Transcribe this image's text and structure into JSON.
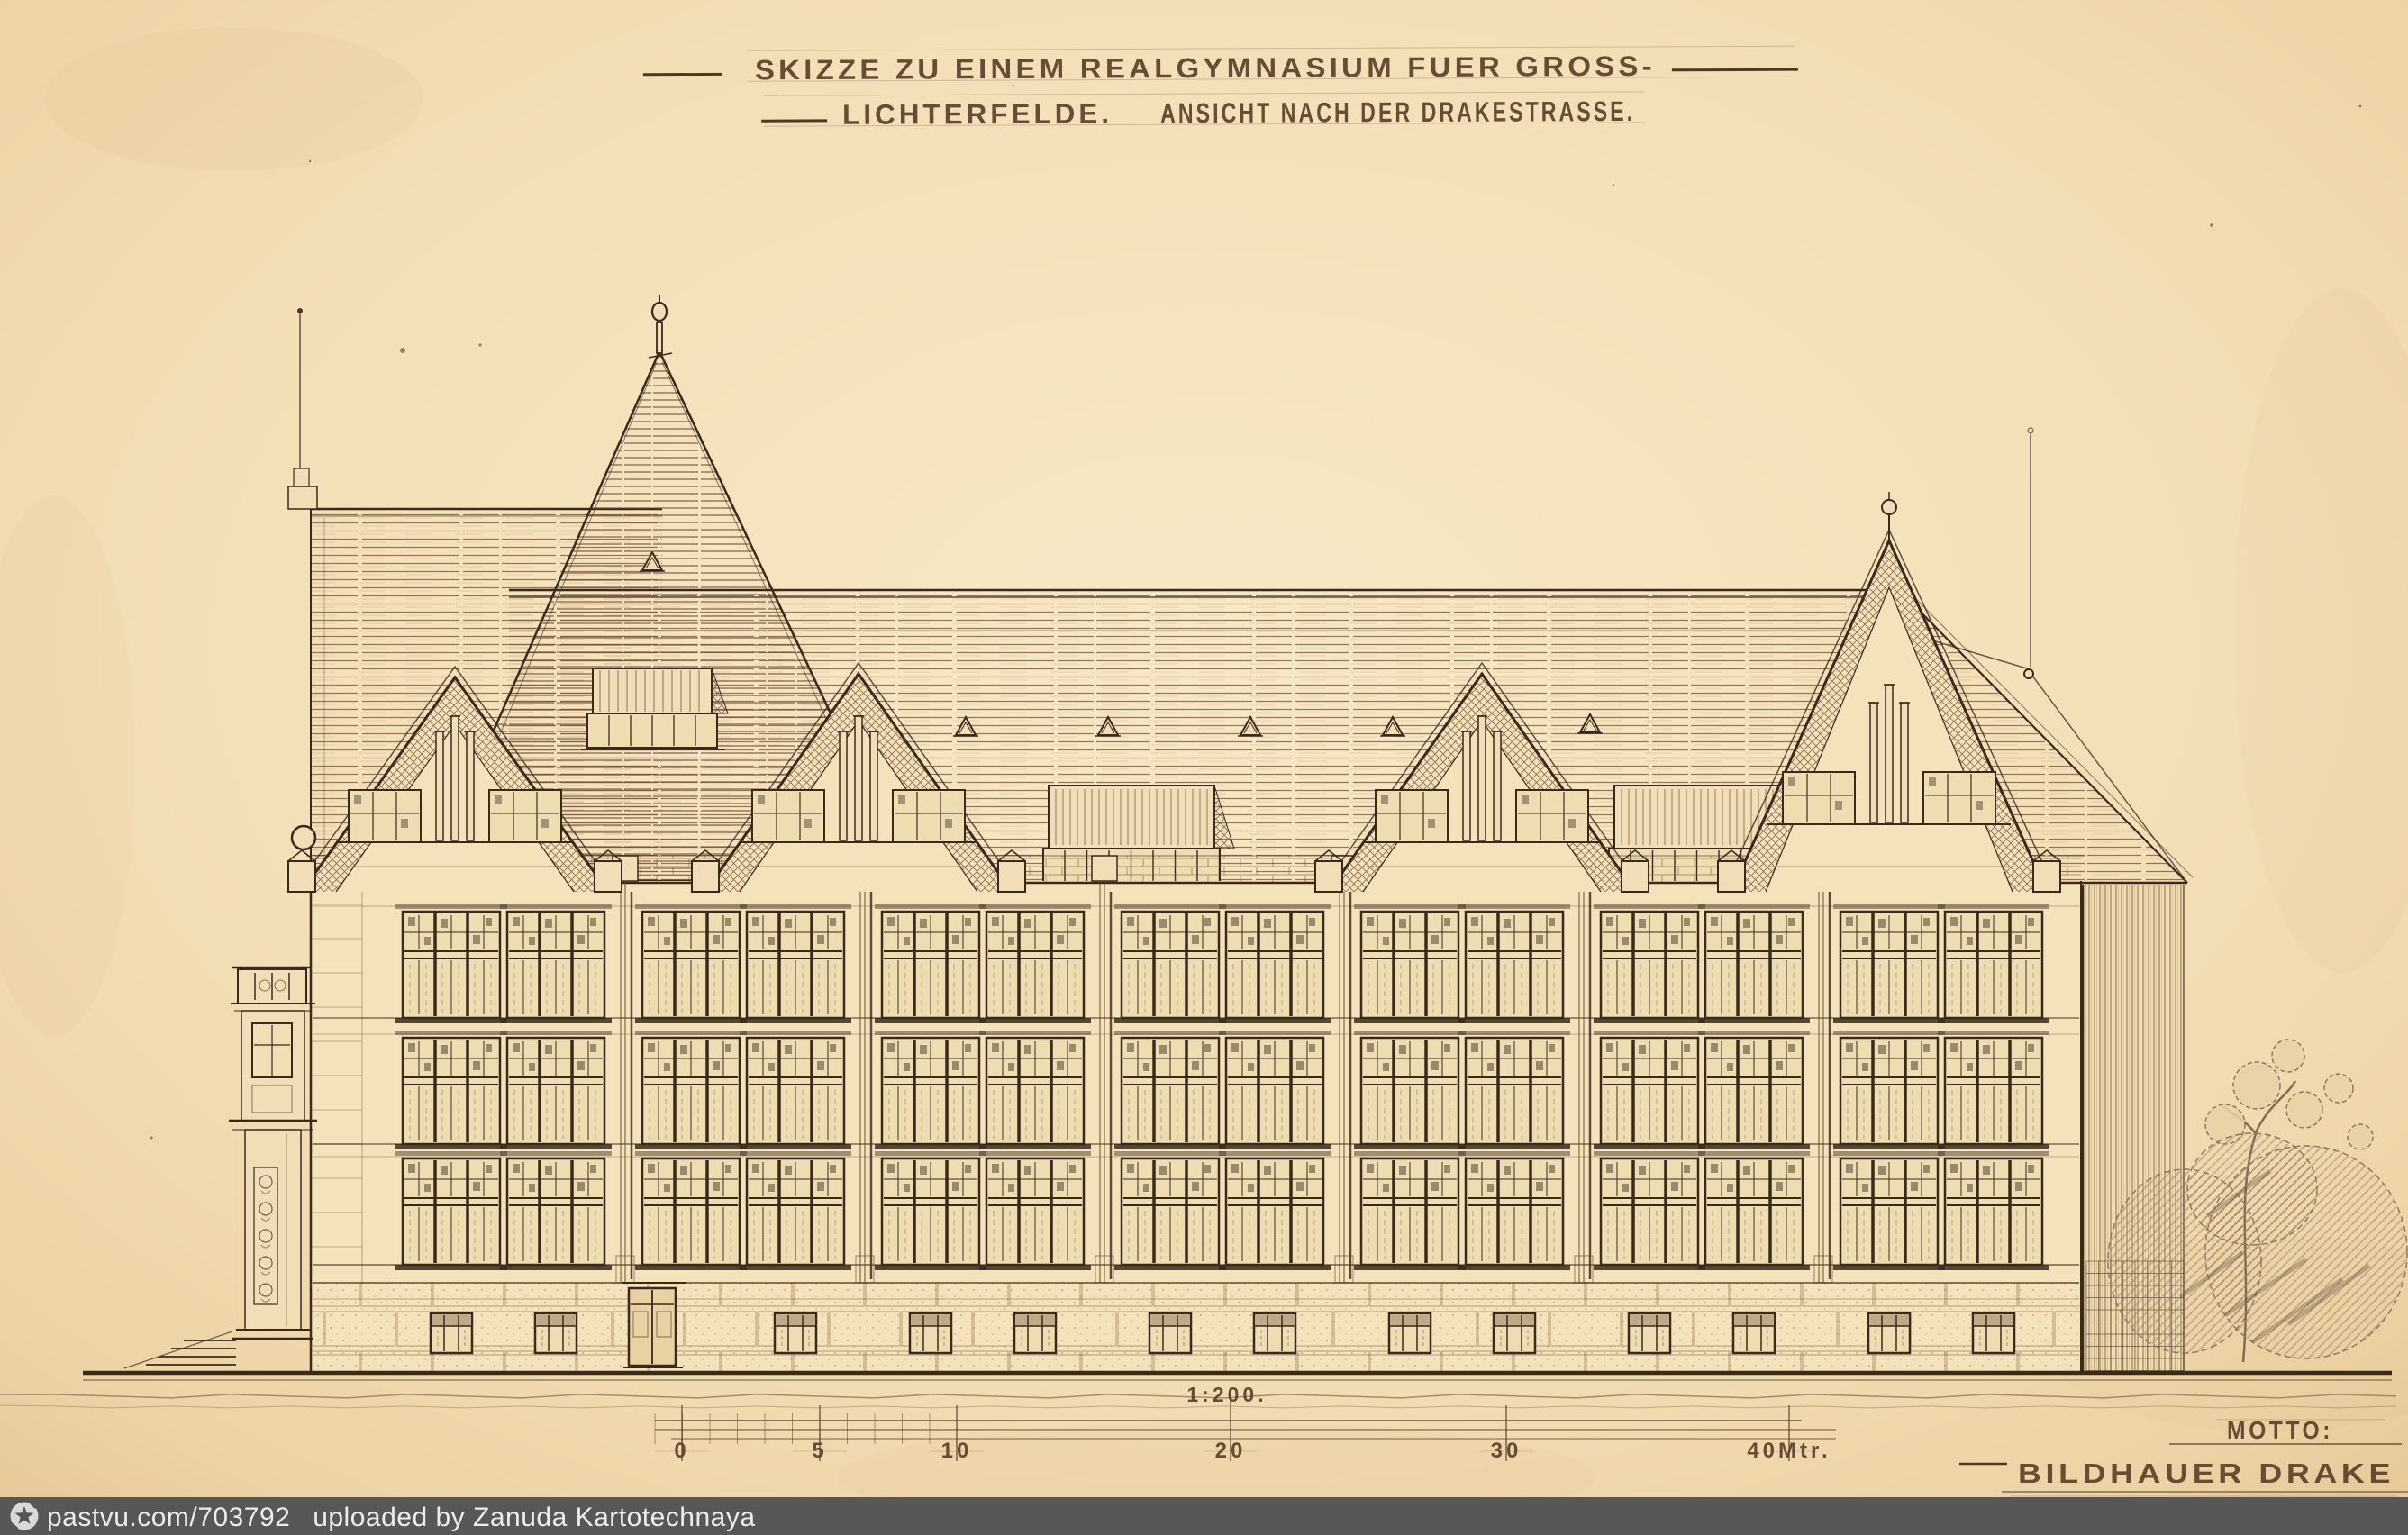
{
  "artwork": {
    "title_line1": "SKIZZE ZU EINEM REALGYMNASIUM FUER GROSS-",
    "title_line2a": "LICHTERFELDE.",
    "title_line2b": "ANSICHT NACH DER DRAKESTRASSE.",
    "scale_label": "1:200.",
    "scale_ticks": [
      "0",
      "5",
      "10",
      "20",
      "30",
      "40Mtr."
    ],
    "motto_label": "MOTTO:",
    "motto_value": "BILDHAUER DRAKE"
  },
  "watermark": {
    "site_ref": "pastvu.com/703792",
    "uploaded_by": "uploaded by Zanuda Kartotechnaya",
    "logo_icon": "star-in-circle",
    "bar_color": "#575757",
    "text_color": "#ececec"
  },
  "colors": {
    "paper": "#f2ddb4",
    "ink": "#3a2a1c",
    "hatch": "#7d5a3b",
    "pencil": "#a08964"
  }
}
